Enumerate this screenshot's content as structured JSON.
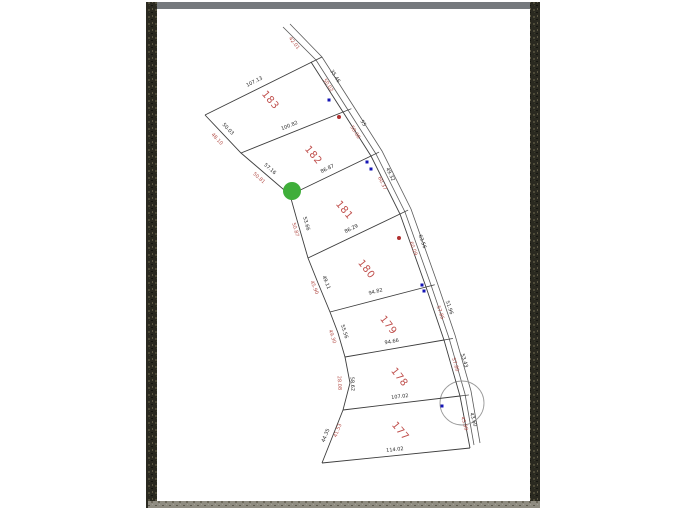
{
  "page": {
    "description_label": "scanned subdivision plat map",
    "colors": {
      "lot_line": "#3d3d3d",
      "road_line": "#5a5a5a",
      "dim_black": "#2a2a2a",
      "dim_red": "#b5524c",
      "lot_number_red": "#c0504d",
      "green_marker": "#3fae3a",
      "blue_marker": "#1515b5",
      "red_marker": "#b03030",
      "culdesac_stroke": "#9a9a9a",
      "border_dark": "#2a2920",
      "border_top": "#75797d",
      "border_bottom": "#8f8c81",
      "paper": "#ffffff"
    }
  },
  "map": {
    "lot_numbers": [
      {
        "text": "183",
        "x": 268,
        "y": 102,
        "rot": 50
      },
      {
        "text": "182",
        "x": 311,
        "y": 157,
        "rot": 50
      },
      {
        "text": "181",
        "x": 342,
        "y": 212,
        "rot": 50
      },
      {
        "text": "180",
        "x": 364,
        "y": 271,
        "rot": 52
      },
      {
        "text": "179",
        "x": 386,
        "y": 327,
        "rot": 52
      },
      {
        "text": "178",
        "x": 397,
        "y": 379,
        "rot": 52
      },
      {
        "text": "177",
        "x": 398,
        "y": 433,
        "rot": 50
      }
    ],
    "left_boundary": [
      [
        205,
        115
      ],
      [
        241,
        153
      ],
      [
        290,
        195
      ],
      [
        297,
        220
      ],
      [
        308,
        258
      ],
      [
        318,
        283
      ],
      [
        330,
        312
      ],
      [
        338,
        333
      ],
      [
        345,
        357
      ],
      [
        350,
        383
      ],
      [
        343,
        410
      ],
      [
        322,
        463
      ]
    ],
    "right_boundary": [
      [
        311,
        62
      ],
      [
        343,
        112
      ],
      [
        371,
        156
      ],
      [
        400,
        214
      ],
      [
        426,
        287
      ],
      [
        444,
        340
      ],
      [
        460,
        396
      ],
      [
        470,
        448
      ]
    ],
    "top_edge": [
      [
        205,
        115
      ],
      [
        322,
        57
      ]
    ],
    "bottom_edge": [
      [
        322,
        463
      ],
      [
        470,
        448
      ]
    ],
    "dividers": [
      {
        "from": [
          241,
          153
        ],
        "to": [
          343,
          112
        ]
      },
      {
        "from": [
          290,
          195
        ],
        "to": [
          371,
          156
        ]
      },
      {
        "from": [
          308,
          258
        ],
        "to": [
          400,
          214
        ]
      },
      {
        "from": [
          330,
          312
        ],
        "to": [
          426,
          287
        ]
      },
      {
        "from": [
          345,
          357
        ],
        "to": [
          444,
          340
        ]
      },
      {
        "from": [
          343,
          410
        ],
        "to": [
          460,
          396
        ]
      }
    ],
    "road": {
      "left": [
        [
          283,
          27
        ],
        [
          316,
          60
        ],
        [
          348,
          110
        ],
        [
          376,
          154
        ],
        [
          405,
          212
        ],
        [
          431,
          285
        ],
        [
          449,
          338
        ],
        [
          465,
          394
        ],
        [
          474,
          445
        ]
      ],
      "right": [
        [
          290,
          24
        ],
        [
          322,
          57
        ],
        [
          354,
          107
        ],
        [
          382,
          151
        ],
        [
          411,
          209
        ],
        [
          437,
          282
        ],
        [
          455,
          335
        ],
        [
          471,
          391
        ],
        [
          480,
          443
        ]
      ]
    },
    "culdesac": {
      "cx": 462,
      "cy": 403,
      "r": 22
    },
    "dim_labels": [
      {
        "text": "107.13",
        "x": 255,
        "y": 83,
        "rot": -27,
        "color": "black"
      },
      {
        "text": "100.82",
        "x": 290,
        "y": 127,
        "rot": -22,
        "color": "black"
      },
      {
        "text": "86.87",
        "x": 328,
        "y": 170,
        "rot": -26,
        "color": "black"
      },
      {
        "text": "86.29",
        "x": 352,
        "y": 230,
        "rot": -26,
        "color": "black"
      },
      {
        "text": "94.82",
        "x": 376,
        "y": 293,
        "rot": -15,
        "color": "black"
      },
      {
        "text": "94.66",
        "x": 392,
        "y": 343,
        "rot": -10,
        "color": "black"
      },
      {
        "text": "107.02",
        "x": 400,
        "y": 398,
        "rot": -7,
        "color": "black"
      },
      {
        "text": "114.02",
        "x": 395,
        "y": 451,
        "rot": -6,
        "color": "black"
      },
      {
        "text": "50.03",
        "x": 227,
        "y": 130,
        "rot": 47,
        "color": "black"
      },
      {
        "text": "48.10",
        "x": 216,
        "y": 140,
        "rot": 47,
        "color": "red"
      },
      {
        "text": "57.16",
        "x": 269,
        "y": 170,
        "rot": 41,
        "color": "black"
      },
      {
        "text": "50.81",
        "x": 258,
        "y": 179,
        "rot": 41,
        "color": "red"
      },
      {
        "text": "53.66",
        "x": 305,
        "y": 224,
        "rot": 74,
        "color": "black"
      },
      {
        "text": "50.87",
        "x": 294,
        "y": 230,
        "rot": 74,
        "color": "red"
      },
      {
        "text": "49.11",
        "x": 325,
        "y": 283,
        "rot": 68,
        "color": "black"
      },
      {
        "text": "45.90",
        "x": 313,
        "y": 288,
        "rot": 68,
        "color": "red"
      },
      {
        "text": "55.56",
        "x": 343,
        "y": 332,
        "rot": 72,
        "color": "black"
      },
      {
        "text": "49.30",
        "x": 331,
        "y": 337,
        "rot": 72,
        "color": "red"
      },
      {
        "text": "58.62",
        "x": 351,
        "y": 384,
        "rot": 87,
        "color": "black"
      },
      {
        "text": "28.08",
        "x": 338,
        "y": 383,
        "rot": 87,
        "color": "red"
      },
      {
        "text": "44.35",
        "x": 327,
        "y": 436,
        "rot": -68,
        "color": "black"
      },
      {
        "text": "41.53",
        "x": 339,
        "y": 431,
        "rot": -68,
        "color": "red"
      },
      {
        "text": "42.01",
        "x": 293,
        "y": 44,
        "rot": 52,
        "color": "red"
      },
      {
        "text": "35.46",
        "x": 334,
        "y": 77,
        "rot": 57,
        "color": "black"
      },
      {
        "text": "50.02",
        "x": 327,
        "y": 86,
        "rot": 57,
        "color": "red"
      },
      {
        "text": "55",
        "x": 362,
        "y": 124,
        "rot": 58,
        "color": "black"
      },
      {
        "text": "58.08",
        "x": 354,
        "y": 133,
        "rot": 58,
        "color": "red"
      },
      {
        "text": "49.32",
        "x": 389,
        "y": 175,
        "rot": 64,
        "color": "black"
      },
      {
        "text": "60.37",
        "x": 381,
        "y": 184,
        "rot": 64,
        "color": "red"
      },
      {
        "text": "63.56",
        "x": 421,
        "y": 242,
        "rot": 70,
        "color": "black"
      },
      {
        "text": "60.09",
        "x": 412,
        "y": 249,
        "rot": 70,
        "color": "red"
      },
      {
        "text": "51.96",
        "x": 448,
        "y": 308,
        "rot": 71,
        "color": "black"
      },
      {
        "text": "57.85",
        "x": 439,
        "y": 313,
        "rot": 71,
        "color": "red"
      },
      {
        "text": "53.43",
        "x": 463,
        "y": 361,
        "rot": 73,
        "color": "black"
      },
      {
        "text": "57.80",
        "x": 454,
        "y": 365,
        "rot": 73,
        "color": "red"
      },
      {
        "text": "43.60",
        "x": 472,
        "y": 420,
        "rot": 74,
        "color": "black"
      },
      {
        "text": "45.99",
        "x": 463,
        "y": 424,
        "rot": 74,
        "color": "red"
      }
    ],
    "markers": {
      "green": {
        "x": 292,
        "y": 191,
        "r": 9
      },
      "blue": [
        [
          329,
          100
        ],
        [
          367,
          162
        ],
        [
          371,
          169
        ],
        [
          422,
          285
        ],
        [
          424,
          291
        ],
        [
          442,
          406
        ]
      ],
      "red": [
        [
          339,
          117
        ],
        [
          399,
          238
        ]
      ]
    }
  }
}
